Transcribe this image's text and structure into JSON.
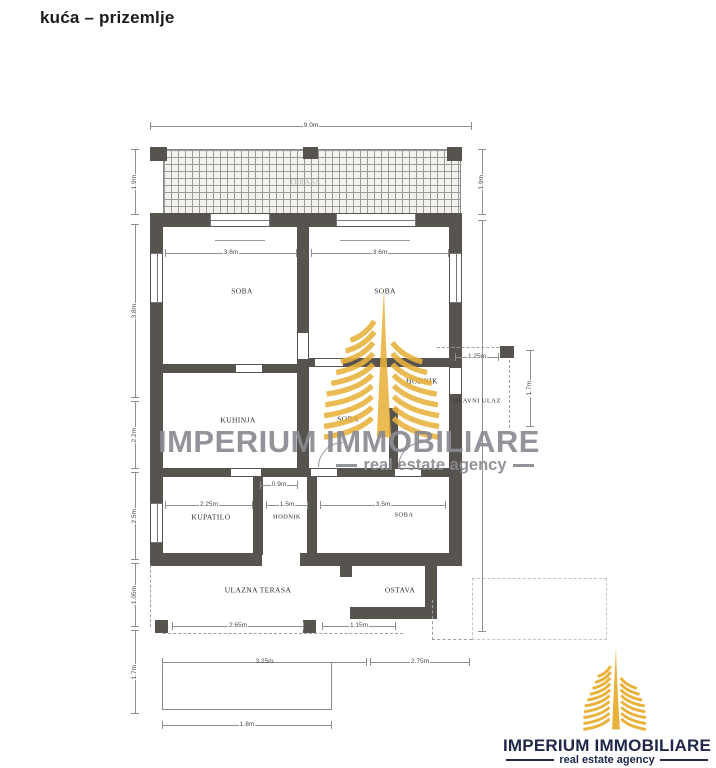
{
  "page": {
    "title": "kuća – prizemlje"
  },
  "watermark": {
    "brand": "IMPERIUM IMMOBILIARE",
    "tagline": "real estate agency"
  },
  "logo": {
    "brand": "IMPERIUM IMMOBILIARE",
    "tagline": "real estate agency"
  },
  "colors": {
    "gold": "#E9B23C",
    "navy": "#20284A",
    "wall_gray": "#57544F",
    "watermark_gray": "#8A8A92"
  },
  "floorplan": {
    "labels": {
      "terasa": "TERASA",
      "soba1": "SOBA",
      "soba2": "SOBA",
      "kuhinja": "KUHINJA",
      "soba3": "SOBA",
      "hodnik1": "HODNIK",
      "glavni_ulaz": "GLAVNI ULAZ",
      "kupatilo": "KUPATILO",
      "hodnik2": "HODNIK",
      "soba4": "SOBA",
      "ulazna_terasa": "ULAZNA TERASA",
      "ostava": "OSTAVA"
    },
    "dims": {
      "top_width": "9.0m",
      "terrace_h_left": "1.9m",
      "terrace_h_right": "1.9m",
      "rooms_h": "3.8m",
      "soba1_w": "3.6m",
      "soba2_w": "3.6m",
      "left_mid": "2.2m",
      "left_low": "2.5m",
      "left_b1": "1.05m",
      "left_b2": "1.7m",
      "porch_w": "1.25m",
      "porch_h": "1.7m",
      "door_w": "0.9m",
      "kupatilo_w": "2.25m",
      "hodnik_w": "1.5m",
      "soba4_w": "3.5m",
      "inner_b1": "2.65m",
      "inner_b2": "1.15m",
      "mid_b1": "3.25m",
      "mid_b2": "2.75m",
      "outer_b": "1.8m"
    }
  }
}
